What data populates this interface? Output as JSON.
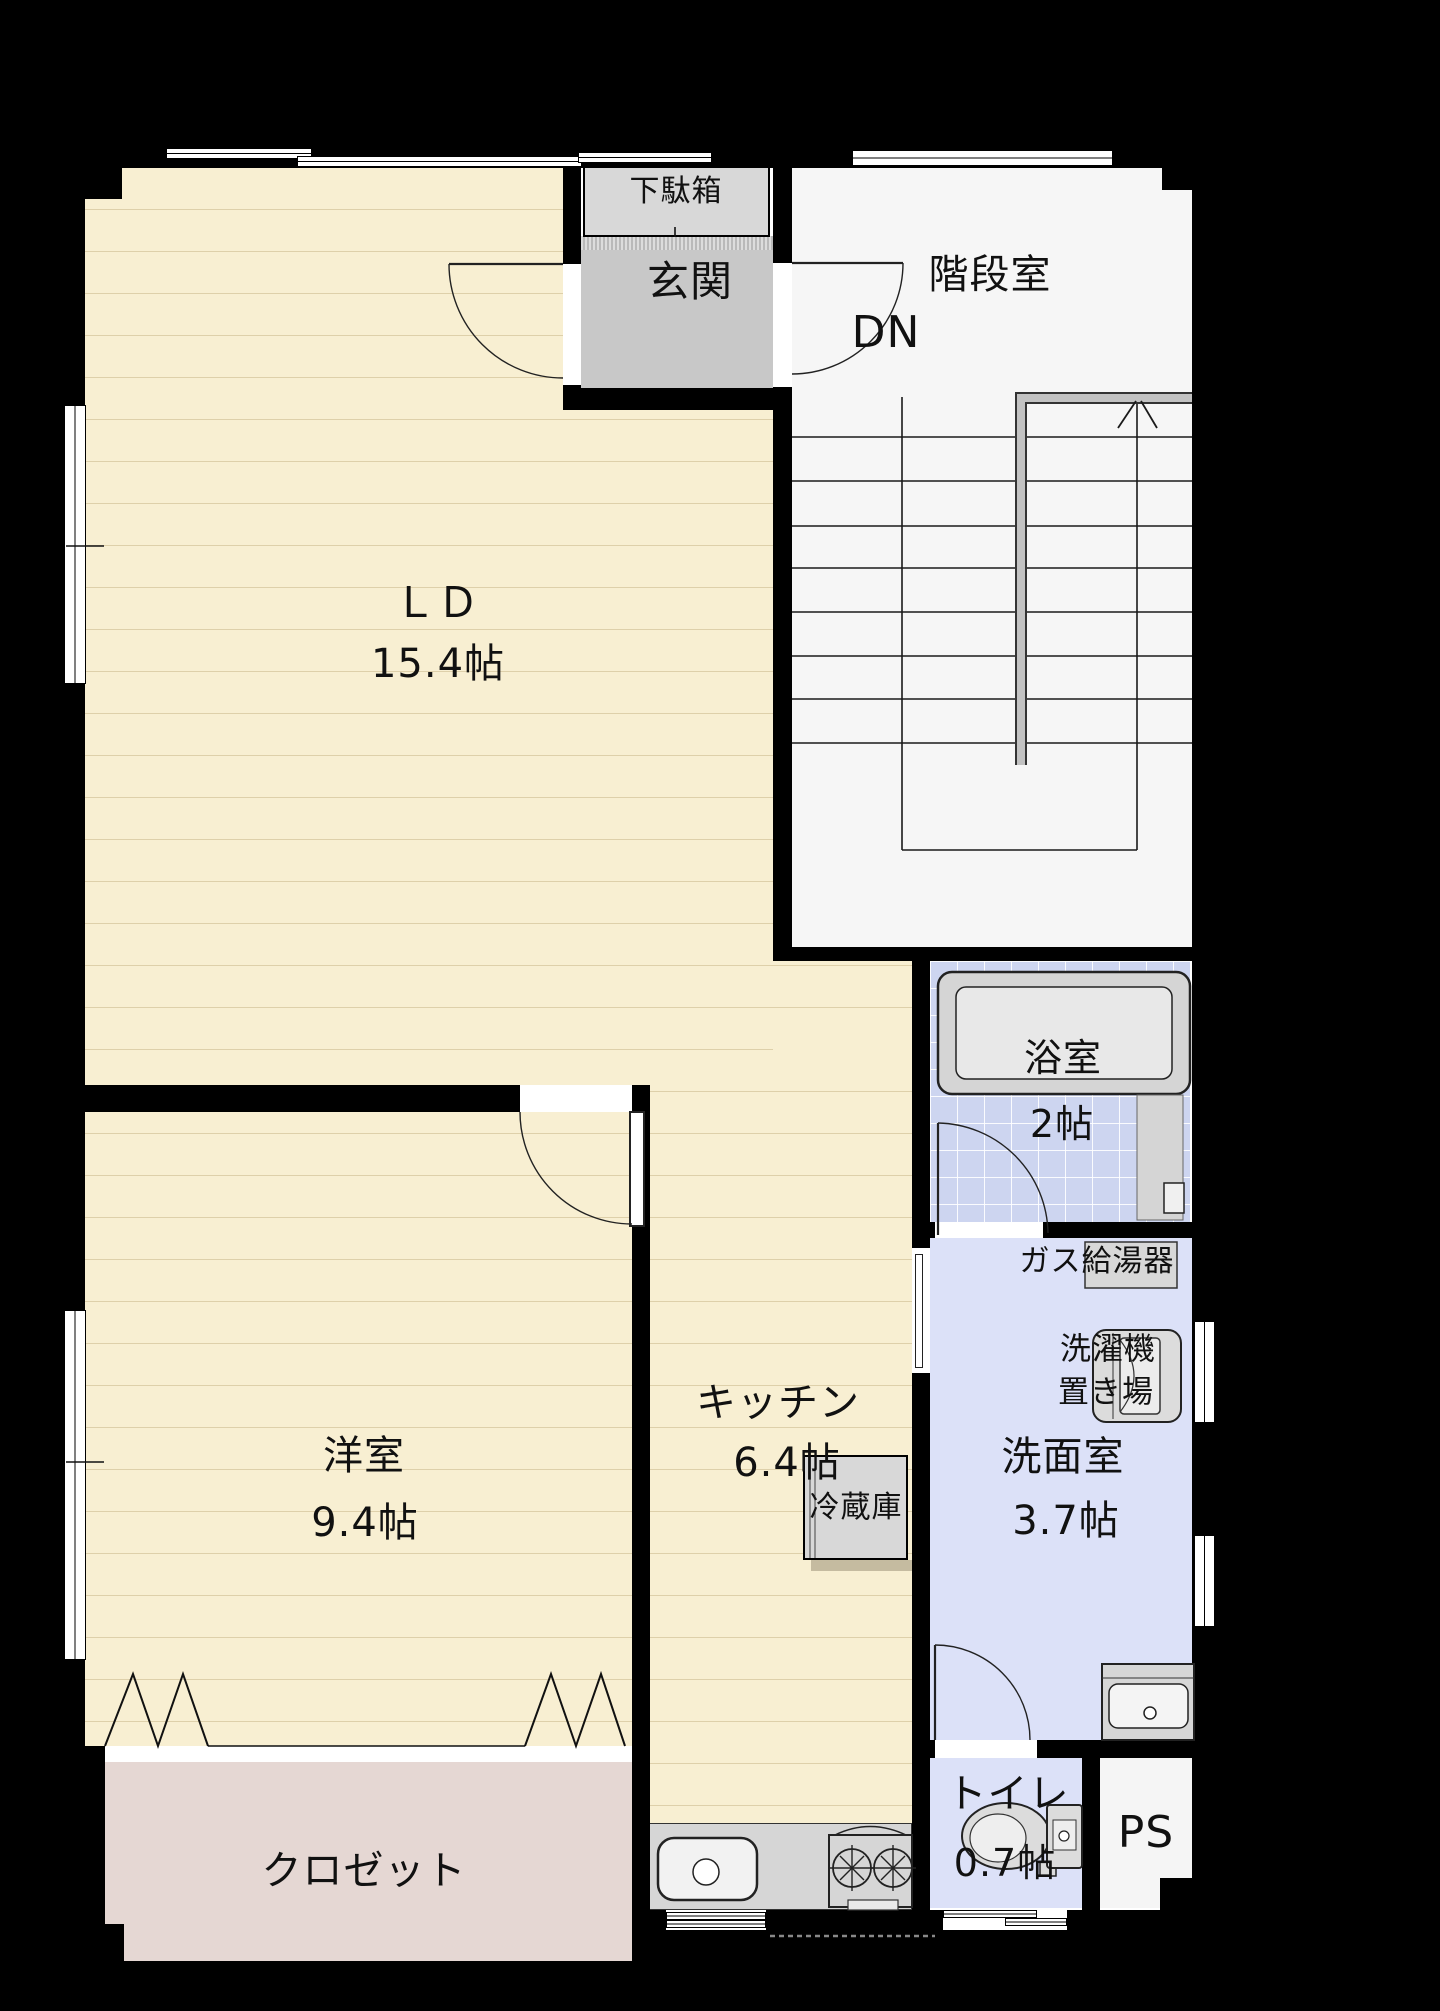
{
  "title": "間取り図（1フロア平面図）",
  "palette": {
    "background": "#000000",
    "wall": "#000000",
    "floor_wood": "#f8efd2",
    "floor_line": "#b29e68",
    "entrance_gray": "#c8c8c8",
    "stairwell_gray": "#f6f6f6",
    "bath_tile_blue": "#cdd5f0",
    "water_rooms_lavender": "#dce1f8",
    "closet_pink": "#e5d7d3",
    "fixture_gray": "#d8d8d8"
  },
  "rooms": {
    "ld": {
      "label": "ＬＤ",
      "size": "15.4帖"
    },
    "western": {
      "label": "洋室",
      "size": "9.4帖"
    },
    "kitchen": {
      "label": "キッチン",
      "size": "6.4帖"
    },
    "entrance": {
      "label": "玄関"
    },
    "stairwell": {
      "label": "階段室",
      "direction": "DN"
    },
    "bath": {
      "label": "浴室",
      "size": "2帖"
    },
    "washroom": {
      "label": "洗面室",
      "size": "3.7帖"
    },
    "toilet": {
      "label": "トイレ",
      "size": "0.7帖"
    },
    "pipe_space": {
      "label": "PS"
    },
    "closet": {
      "label": "クロゼット"
    }
  },
  "fixtures": {
    "shoe_cabinet": {
      "label": "下駄箱"
    },
    "refrigerator": {
      "label": "冷蔵庫"
    },
    "gas_water_heater": {
      "label": "ガス給湯器"
    },
    "washer_space": {
      "label_line1": "洗濯機",
      "label_line2": "置き場"
    }
  }
}
